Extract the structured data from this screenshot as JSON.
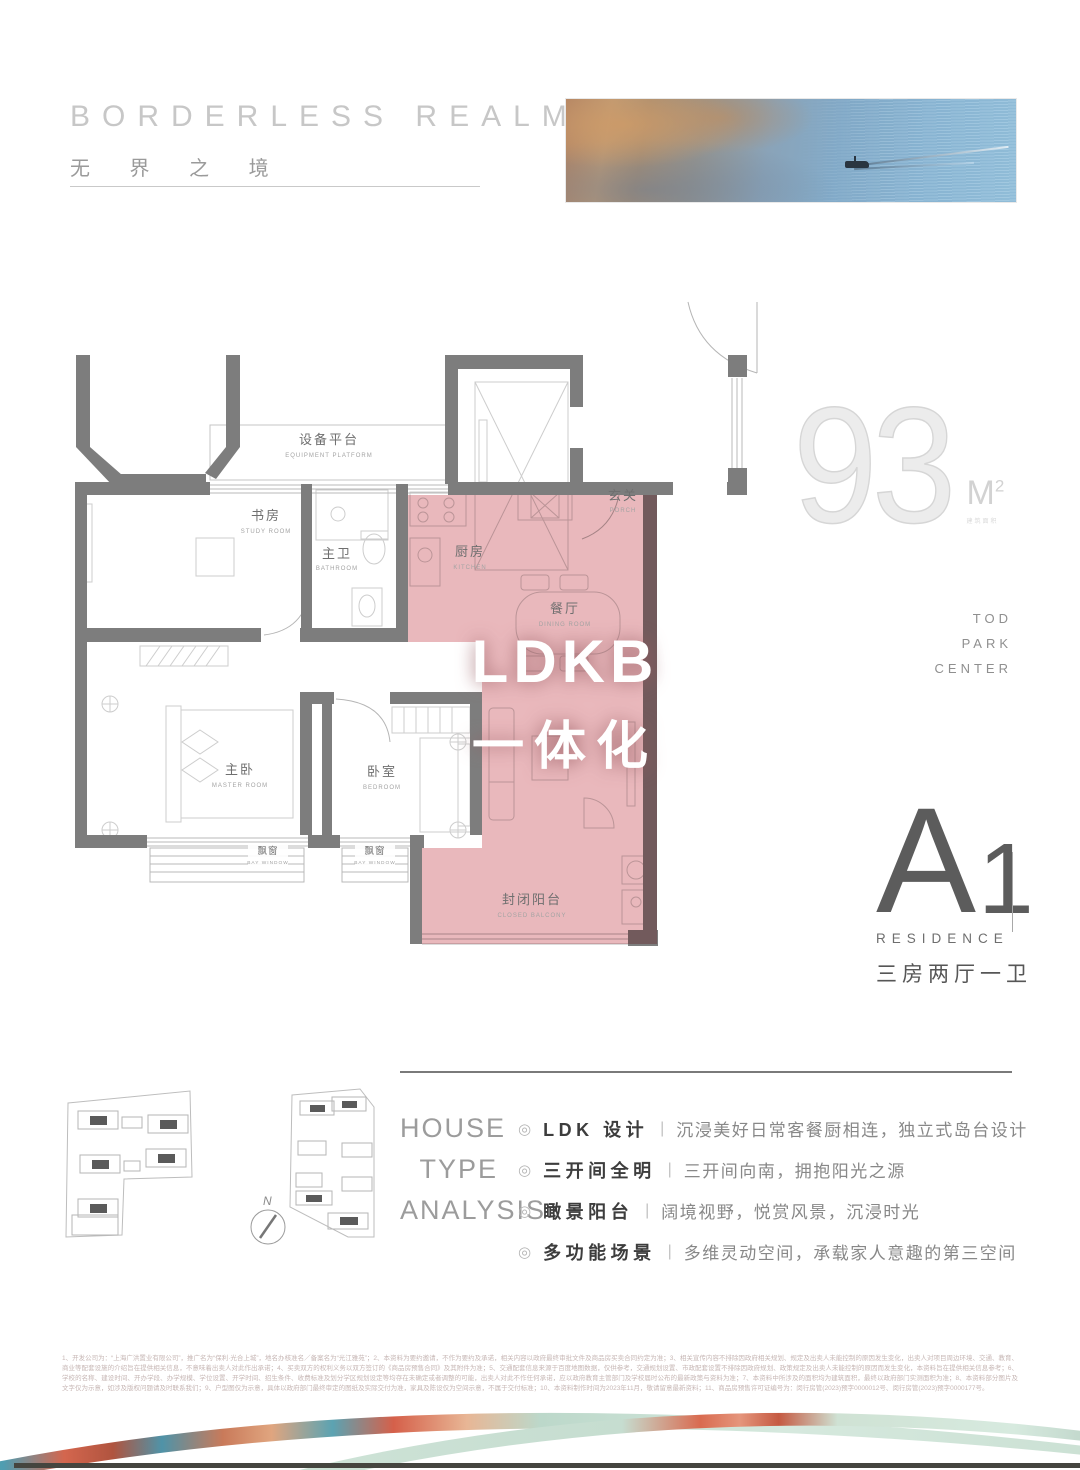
{
  "header": {
    "title_en": "BORDERLESS REALM",
    "title_cn": "无 界 之 境"
  },
  "area": {
    "value": "93",
    "unit_m": "M",
    "unit_sup": "2",
    "note": "建筑面积"
  },
  "brand": {
    "lines": [
      "TOD",
      "PARK",
      "CENTER"
    ]
  },
  "badge": {
    "letter": "A",
    "number": "1",
    "sub": "RESIDENCE",
    "type_cn": "三房两厅一卫"
  },
  "floorplan": {
    "highlight": {
      "line1": "LDKB",
      "line2": "一体化"
    },
    "colors": {
      "highlight_pink": "#e8b2b7",
      "wall_gray": "#7d7d7d"
    },
    "rooms": [
      {
        "cn": "设备平台",
        "en": "EQUIPMENT PLATFORM"
      },
      {
        "cn": "书房",
        "en": "STUDY ROOM"
      },
      {
        "cn": "主卫",
        "en": "BATHROOM"
      },
      {
        "cn": "厨房",
        "en": "KITCHEN"
      },
      {
        "cn": "玄关",
        "en": "PORCH"
      },
      {
        "cn": "餐厅",
        "en": "DINING ROOM"
      },
      {
        "cn": "主卧",
        "en": "MASTER ROOM"
      },
      {
        "cn": "卧室",
        "en": "BEDROOM"
      },
      {
        "cn": "飘窗",
        "en": "BAY WINDOW"
      },
      {
        "cn": "飘窗",
        "en": "BAY WINDOW"
      },
      {
        "cn": "封闭阳台",
        "en": "CLOSED BALCONY"
      }
    ],
    "compass": {
      "label": "N"
    }
  },
  "analysis": {
    "heading_lines": [
      "HOUSE",
      "TYPE",
      "ANALYSIS"
    ],
    "bullet": "◎",
    "divider": "|",
    "items": [
      {
        "label": "LDK 设计",
        "desc": "沉浸美好日常客餐厨相连，独立式岛台设计"
      },
      {
        "label": "三开间全明",
        "desc": "三开间向南，拥抱阳光之源"
      },
      {
        "label": "瞰景阳台",
        "desc": "阔境视野，悦赏风景，沉浸时光"
      },
      {
        "label": "多功能场景",
        "desc": "多维灵动空间，承载家人意趣的第三空间"
      }
    ]
  },
  "disclaimer": {
    "text": "1、开发公司为：“上海广洪置业有限公司”，推广名为“保利·光合上城”，地名办核准名／备案名为“光江雅苑”；2、本资料为要约邀请，不作为要约及承诺，相关内容以政府最终审批文件及商品房买卖合同约定为准；3、相关宣传内容不排除因政府相关规划、规定及出卖人未能控制的原因发生变化，出卖人对项目周边环境、交通、教育、商业等配套设施的介绍旨在提供相关信息，不意味着出卖人对此作出承诺；4、买卖双方的权利义务以双方签订的《商品房预售合同》及其附件为准；5、交通配套信息来源于百度地图数据，仅供参考，交通规划设置、市政配套设置不排除因政府规划、政策规定及出卖人未能控制的原因而发生变化，本资料旨在提供相关信息参考；6、学校的名称、建设时间、开办学段、办学规模、学位设置、开学时间、招生条件、收费标准及划分学区规划设定等均存在未确定或者调整的可能，出卖人对此不作任何承诺，应以政府教育主管部门及学校届时公布的最新政策与资料为准；7、本资料中所涉及的面积均为建筑面积，最终以政府部门实测面积为准；8、本资料部分图片及文字仅为示意，如涉及版权问题请及时联系我们；9、户型图仅为示意，具体以政府部门最终审定的图纸及实际交付为准，家具及陈设仅为空间示意，不属于交付标准；10、本资料制作时间为2023年11月，敬请留意最新资料；11、商品房预售许可证编号为：闵行房管(2023)预字0000012号、闵行房管(2023)预字0000177号。"
  }
}
